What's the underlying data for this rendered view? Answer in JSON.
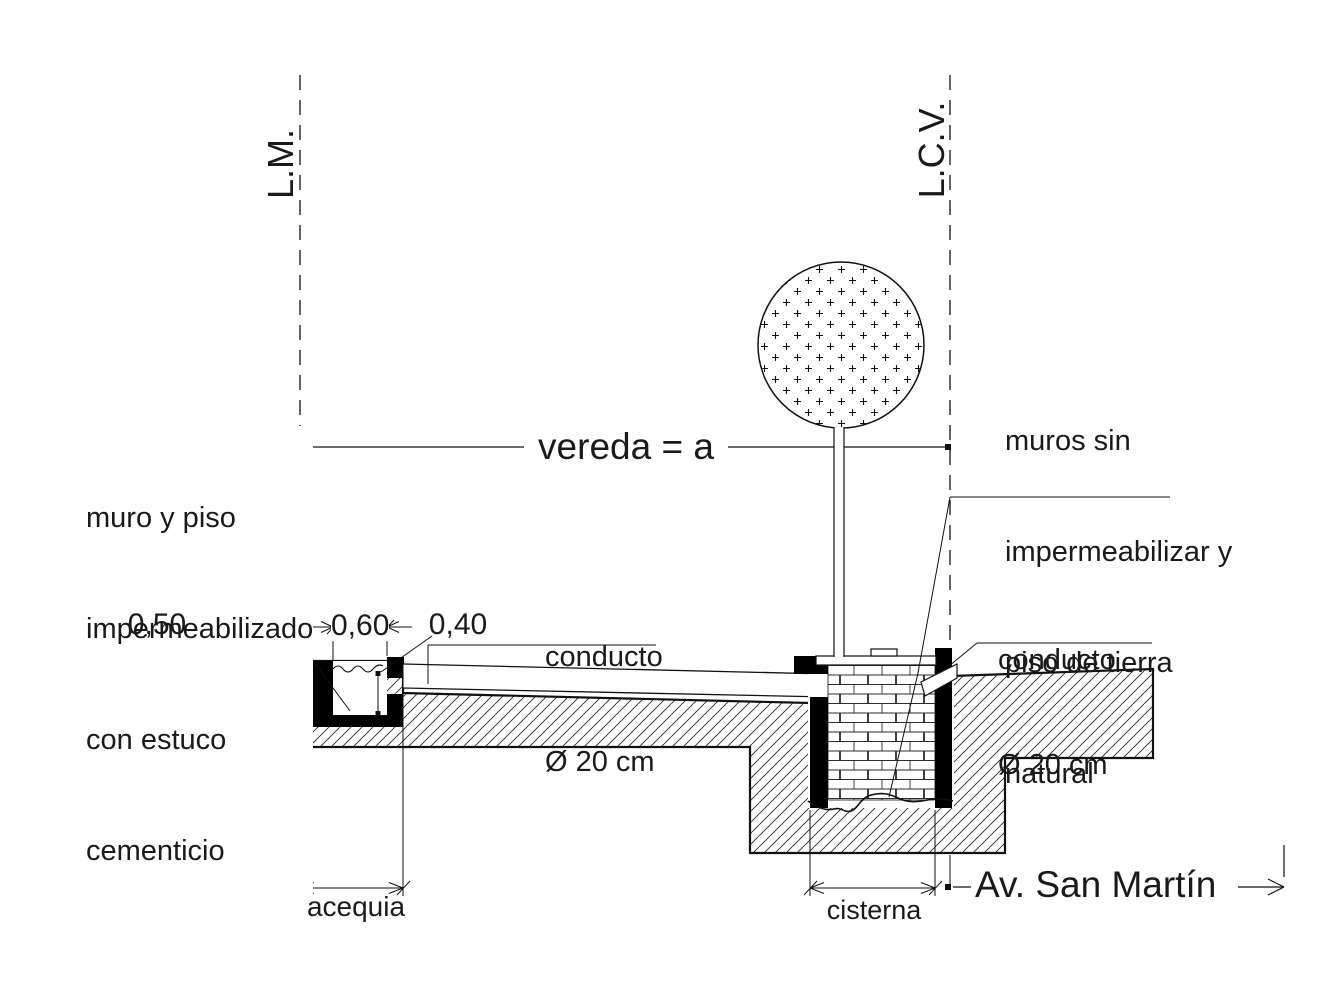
{
  "reference_lines": {
    "lm_label": "L.M.",
    "lcv_label": "L.C.V."
  },
  "dimensions": {
    "vereda": "vereda = a",
    "depth_total": "0,50",
    "channel_width": "0,60",
    "inner_depth": "0,40",
    "acequia": "acequia",
    "cisterna": "cisterna"
  },
  "notes": {
    "left": {
      "line1": "muro y piso",
      "line2": "impermeabilizado",
      "line3": "con estuco",
      "line4": "cementicio"
    },
    "right": {
      "line1": "muros sin",
      "line2": "impermeabilizar y",
      "line3": "piso de tierra",
      "line4": "natural"
    },
    "conducto_left": {
      "line1": "conducto",
      "line2": "Ø 20 cm"
    },
    "conducto_right": {
      "line1": "conducto",
      "line2": "Ø 20 cm"
    }
  },
  "street": "Av. San Martín",
  "colors": {
    "ink": "#1a1a1a",
    "solid_fill": "#000000",
    "background": "#ffffff"
  }
}
